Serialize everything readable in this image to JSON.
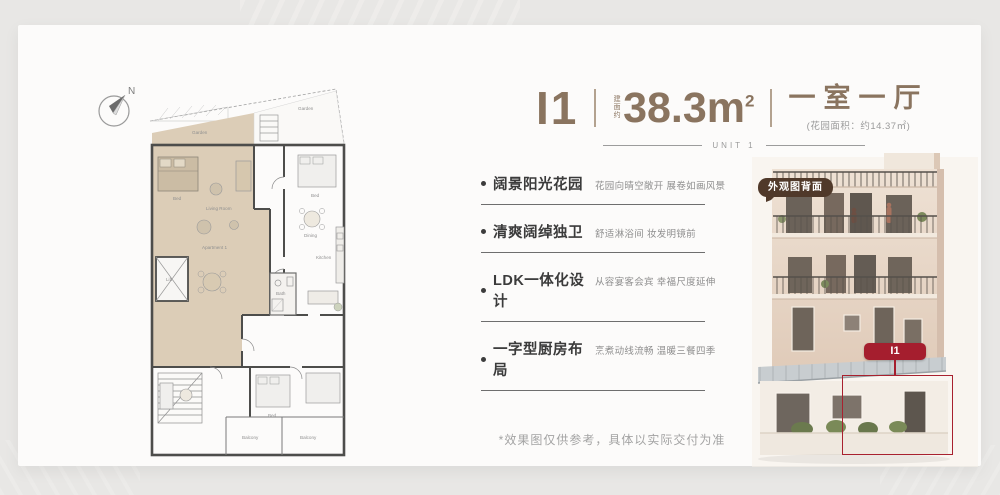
{
  "colors": {
    "accent_brown": "#8a745f",
    "badge_brown": "#50392a",
    "accent_red": "#a51e2e",
    "text_dark": "#3b3b3b",
    "text_gray": "#8f8f8f",
    "plan_highlight": "#dccdb7"
  },
  "compass": {
    "label": "N"
  },
  "header": {
    "unit_code": "I1",
    "area_prefix": "建面约",
    "area_value": "38.3m",
    "area_exp": "2",
    "layout_type": "一室一厅",
    "garden_note": "(花园面积：约14.37㎡)",
    "unit_caption": "UNIT 1"
  },
  "features": [
    {
      "title": "阔景阳光花园",
      "desc": "花园向晴空敞开 展卷如画风景"
    },
    {
      "title": "清爽阔绰独卫",
      "desc": "舒适淋浴间 妆发明镜前"
    },
    {
      "title": "LDK一体化设计",
      "desc": "从容宴客会宾 幸福尺度延伸"
    },
    {
      "title": "一字型厨房布局",
      "desc": "烹煮动线流畅 温暖三餐四季"
    }
  ],
  "disclaimer": "*效果图仅供参考，具体以实际交付为准",
  "photo": {
    "badge_label": "外观图背面",
    "unit_tag": "I1"
  },
  "floorplan": {
    "labels": {
      "garden": "Garden",
      "garden2": "Garden",
      "bed": "Bed",
      "living": "Living Room",
      "apartment": "Apartment 1",
      "lift": "Lift",
      "bath": "Bath",
      "kitchen": "Kitchen",
      "bed2": "Bed",
      "dining": "Dining",
      "bed3": "Bed",
      "balcony1": "Balcony",
      "balcony2": "Balcony"
    }
  }
}
